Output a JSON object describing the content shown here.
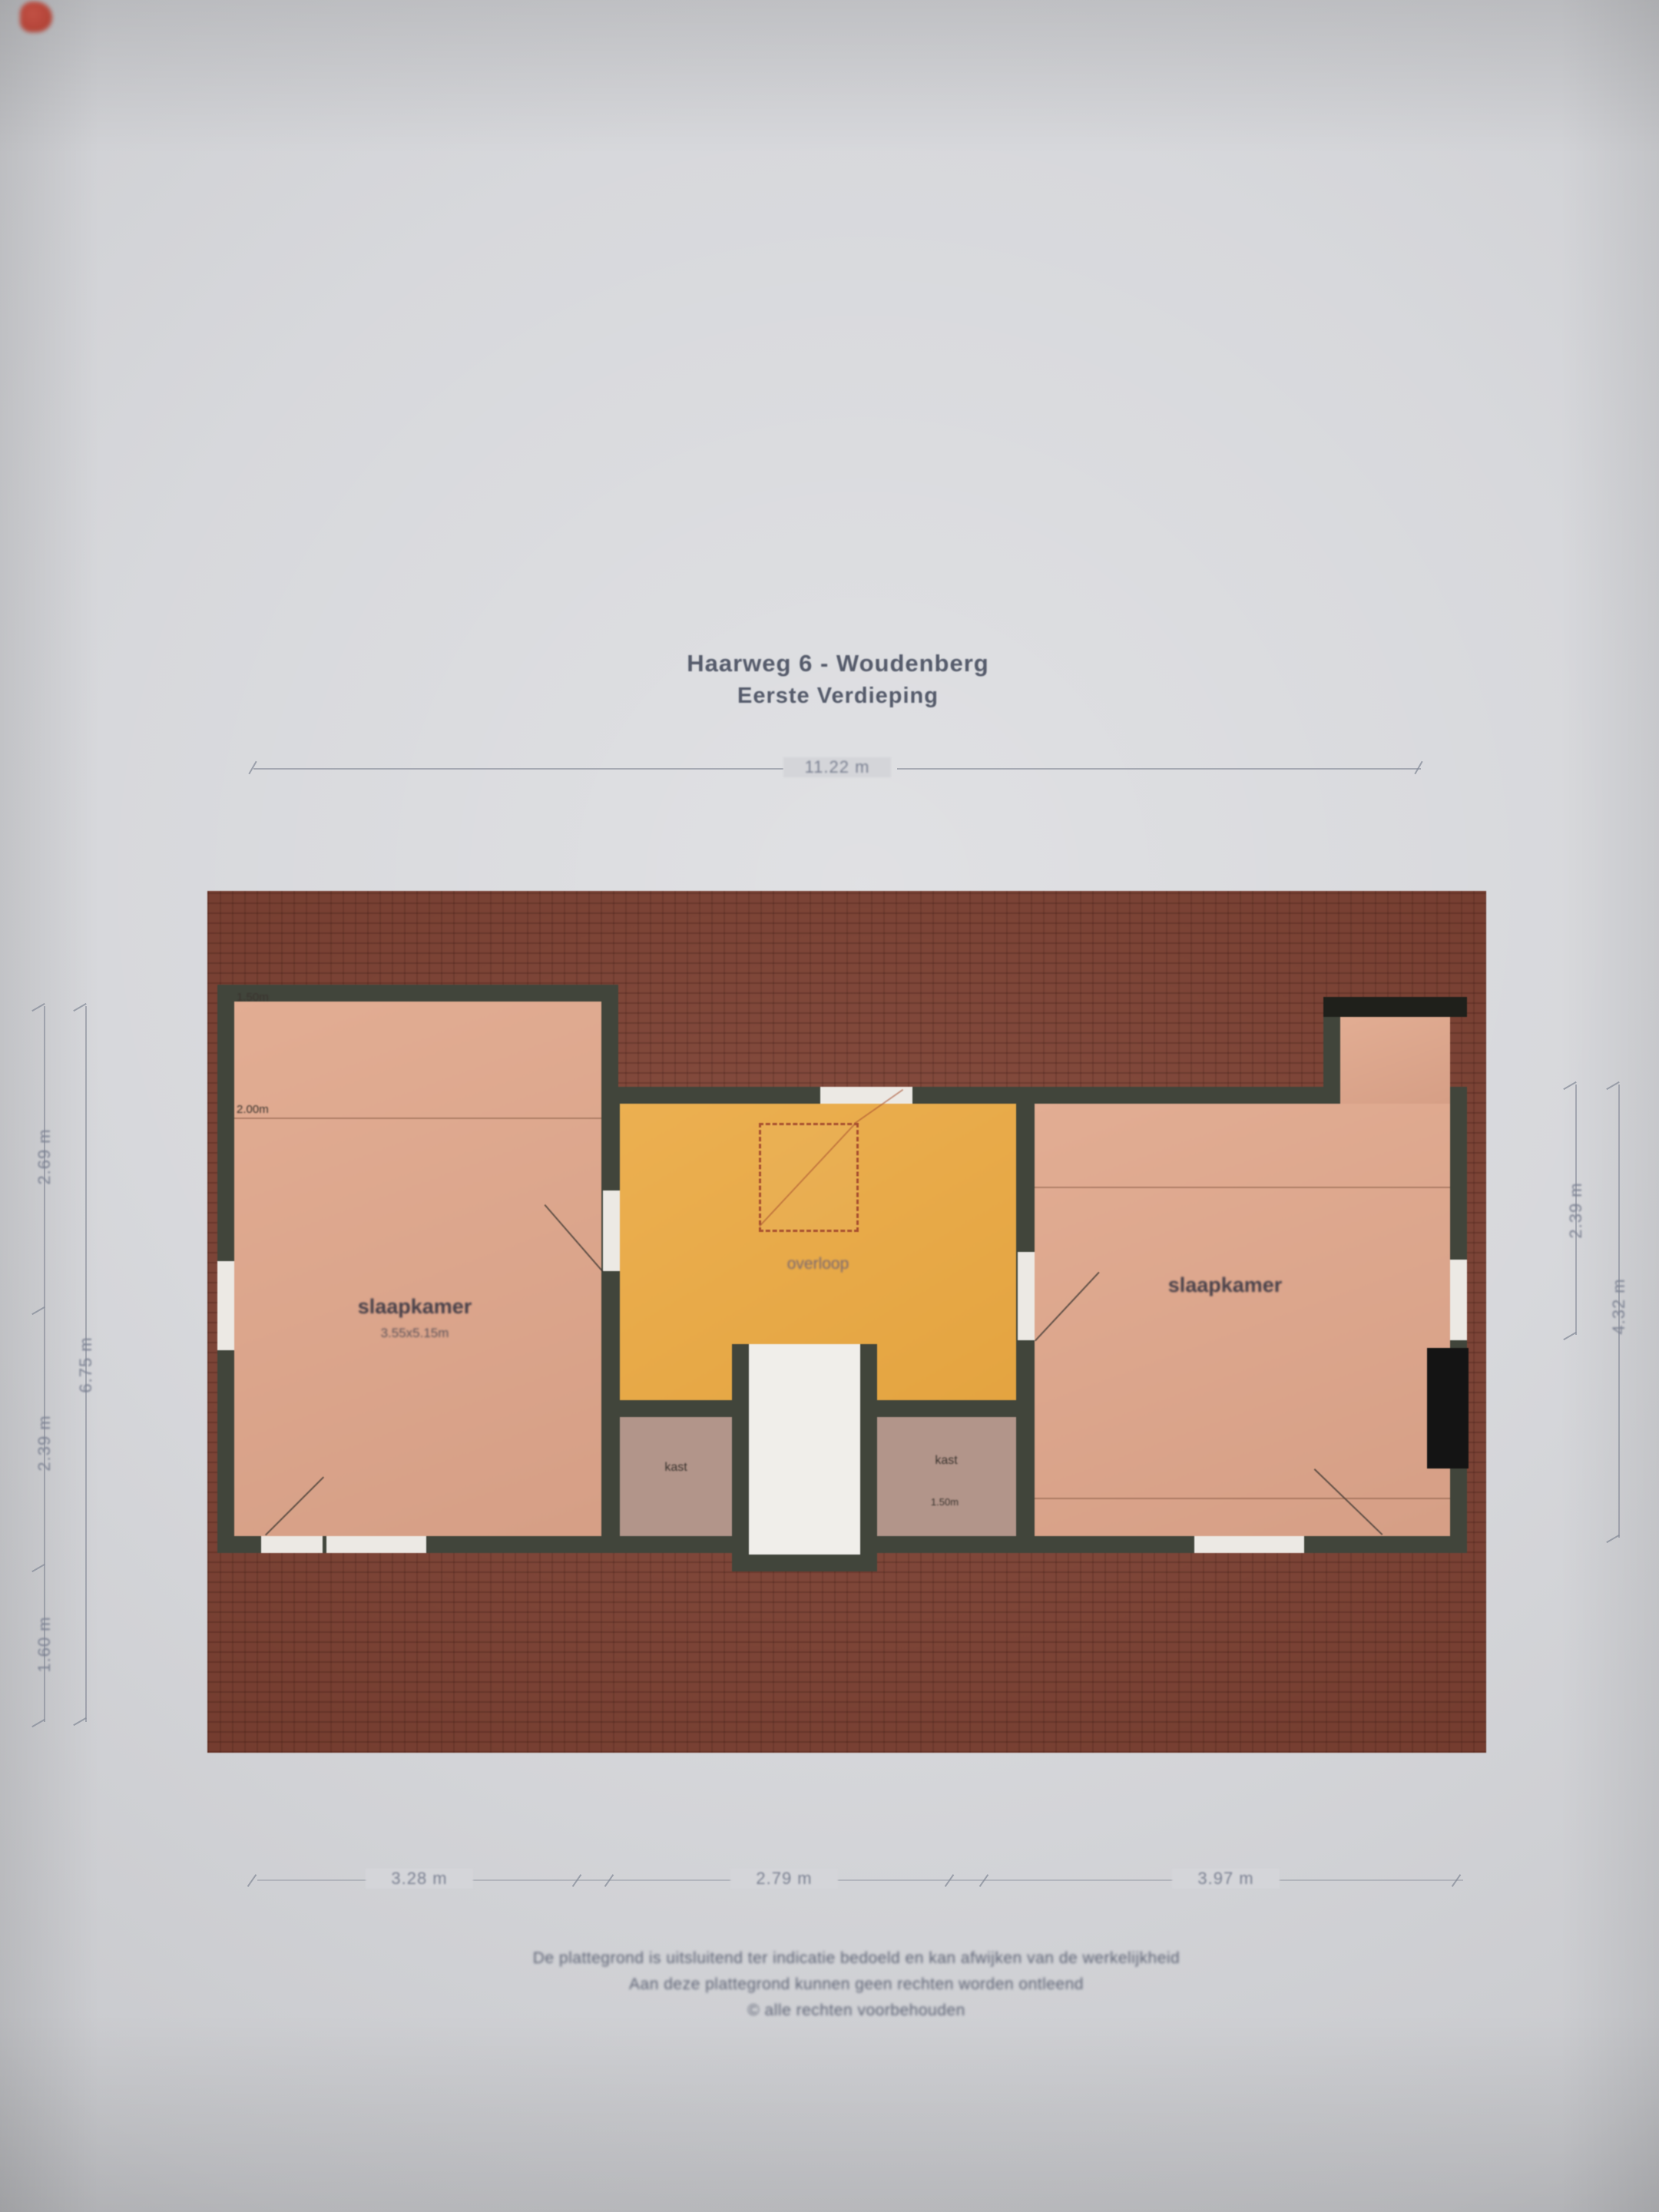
{
  "doc": {
    "title_line1": "Haarweg 6 - Woudenberg",
    "title_line2": "Eerste Verdieping"
  },
  "dimensions": {
    "top_width": "11.22 m",
    "bottom": [
      "3.28 m",
      "2.79 m",
      "3.97 m"
    ],
    "left_total": "6.75 m",
    "left_segments": [
      "2.69 m",
      "2.39 m",
      "1.60 m"
    ],
    "right_inner": "2.39 m",
    "right_outer": "4.32 m"
  },
  "rooms": {
    "bedroom_left": {
      "label": "slaapkamer",
      "size": "3.55x5.15m"
    },
    "bedroom_right": {
      "label": "slaapkamer"
    },
    "landing": {
      "label": "overloop"
    },
    "closet_left": {
      "label": "kast"
    },
    "closet_right": {
      "label": "kast",
      "note": "1.50m"
    },
    "height_line_top": "1.50m",
    "height_line_mid": "2.00m"
  },
  "footer": {
    "line1": "De plattegrond is uitsluitend ter indicatie bedoeld en kan afwijken van de werkelijkheid",
    "line2": "Aan deze plattegrond kunnen geen rechten worden ontleend",
    "line3": "© alle rechten voorbehouden"
  },
  "colors": {
    "paper": "#d4d5d9",
    "roof": "#7c3d2e",
    "wall": "#41453b",
    "bedroom_floor": "#dca78e",
    "landing_floor": "#e7a845",
    "closet_floor": "#b2958a",
    "stair_white": "#f0eeea",
    "dash_red": "#a8502f",
    "text_dark": "#555b6b",
    "dim_text": "#7b8192",
    "mark_red": "#b23a2c"
  }
}
